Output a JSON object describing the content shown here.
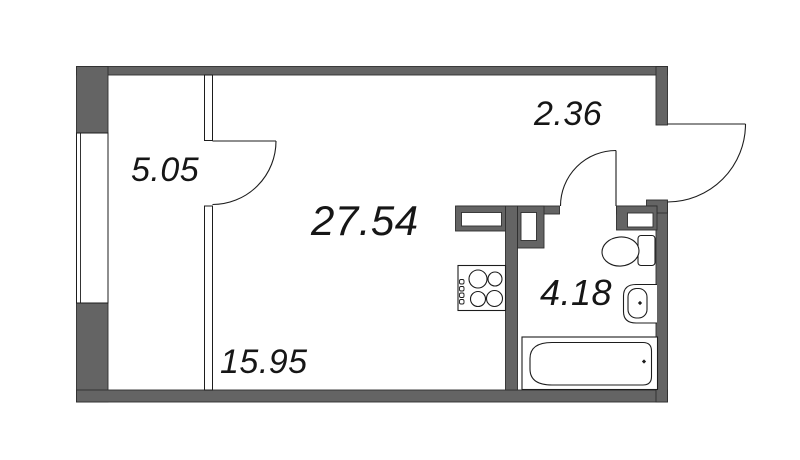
{
  "plan": {
    "total_area_label": "27.54",
    "rooms": [
      {
        "name": "hallway",
        "area_label": "5.05"
      },
      {
        "name": "entry-hall",
        "area_label": "2.36"
      },
      {
        "name": "main-room",
        "area_label": "15.95"
      },
      {
        "name": "bathroom",
        "area_label": "4.18"
      }
    ],
    "fixtures": [
      "stove-cooktop",
      "toilet",
      "sink",
      "bathtub"
    ],
    "doors": [
      "hallway-door",
      "entry-hall-door",
      "entrance-door"
    ],
    "window": "left-wall-window",
    "colors": {
      "wall": "#646464",
      "line": "#1d1d1d",
      "bg": "#ffffff",
      "label": "#161616"
    }
  }
}
